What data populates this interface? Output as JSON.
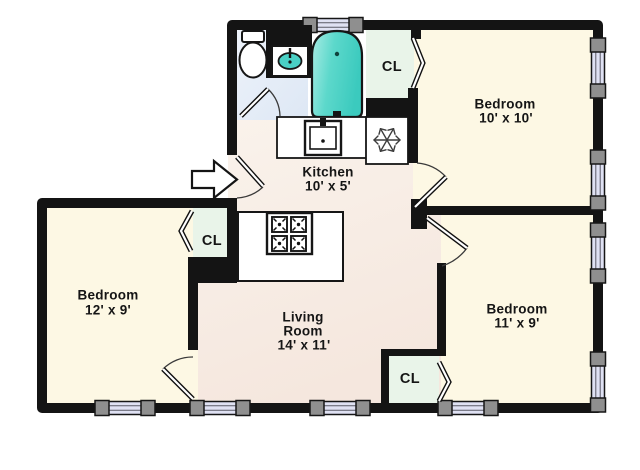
{
  "title": "Apartment floor plan",
  "rooms": {
    "bedroom_top_right": {
      "name": "Bedroom",
      "dims": "10' x 10'"
    },
    "bedroom_left": {
      "name": "Bedroom",
      "dims": "12' x 9'"
    },
    "bedroom_bottom_right": {
      "name": "Bedroom",
      "dims": "11' x 9'"
    },
    "kitchen": {
      "name": "Kitchen",
      "dims": "10' x 5'"
    },
    "living_room": {
      "line1": "Living",
      "line2": "Room",
      "dims": "14' x 11'"
    },
    "closets": {
      "top": "CL",
      "left": "CL",
      "bottom": "CL"
    }
  },
  "fixtures": [
    "toilet",
    "vanity-sink",
    "bathtub",
    "kitchen-sink",
    "refrigerator-snowflake",
    "range-burners",
    "entry-arrow",
    "door-swing",
    "bifold-door",
    "window"
  ],
  "palette": {
    "wall": "#141414",
    "bedroom_floor": "#fdf8e4",
    "living_kitchen_floor": "#f8eee6",
    "bathroom_floor": "#e6edf8",
    "closet_floor": "#e9f4e9",
    "fixture_teal": "#4ad0c5",
    "window_glass": "#dfe1f3",
    "window_frame": "#8f8f8f"
  }
}
